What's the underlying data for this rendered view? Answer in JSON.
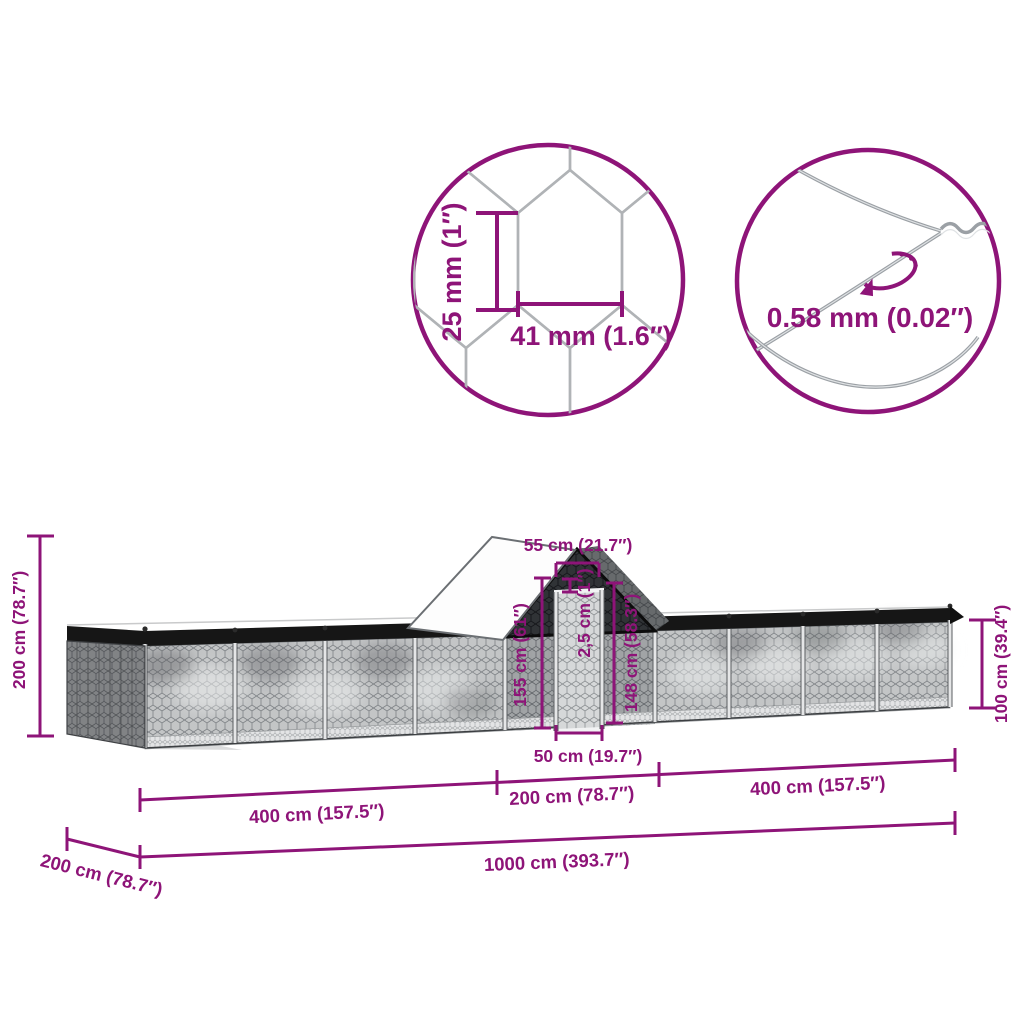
{
  "accent_color": "#8E1478",
  "mesh_callout": {
    "mesh_height_label": "25 mm (1″)",
    "mesh_width_label": "41 mm (1.6″)"
  },
  "wire_callout": {
    "wire_diameter_label": "0.58 mm (0.02″)"
  },
  "dims": {
    "total_height": "200 cm (78.7″)",
    "run_height": "100 cm (39.4″)",
    "coop_top_width": "55 cm (21.7″)",
    "coop_height": "155 cm (61″)",
    "panel_thickness": "2,5 cm (1″)",
    "coop_wall_height": "148 cm (58.3″)",
    "door_width": "50 cm (19.7″)",
    "left_run_length": "400 cm (157.5″)",
    "coop_length": "200 cm (78.7″)",
    "right_run_length": "400 cm (157.5″)",
    "total_length": "1000 cm (393.7″)",
    "depth": "200 cm (78.7″)"
  }
}
